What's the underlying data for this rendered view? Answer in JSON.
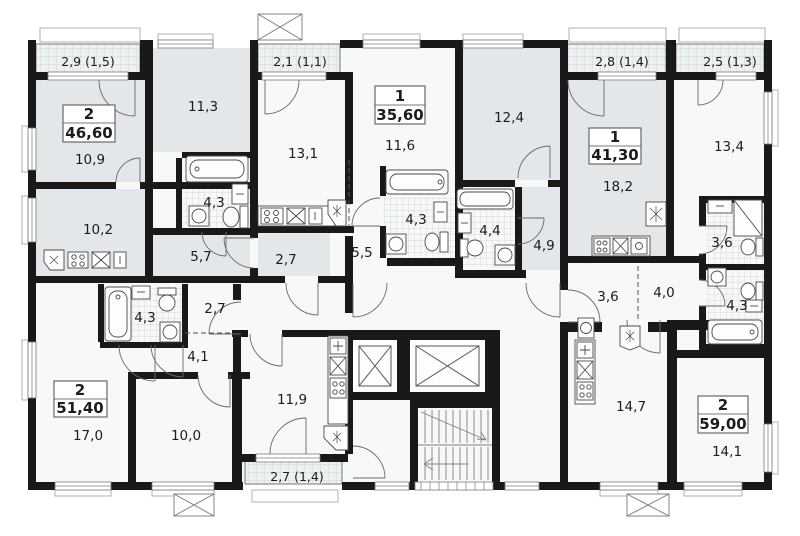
{
  "page": {
    "title": "Apartment floor plan"
  },
  "apartments": {
    "a46": {
      "rooms": "2",
      "area": "46,60"
    },
    "a35": {
      "rooms": "1",
      "area": "35,60"
    },
    "a41": {
      "rooms": "1",
      "area": "41,30"
    },
    "a51": {
      "rooms": "2",
      "area": "51,40"
    },
    "a59": {
      "rooms": "2",
      "area": "59,00"
    }
  },
  "room_areas": {
    "r10_9": "10,9",
    "r11_3": "11,3",
    "r10_2": "10,2",
    "bath_tl": "4,3",
    "kitchen_5_7": "5,7",
    "hall_2_7_top": "2,7",
    "r13_1": "13,1",
    "r11_6": "11,6",
    "bath_35": "4,3",
    "hall_5_5": "5,5",
    "r12_4": "12,4",
    "bath_4_4": "4,4",
    "hall_4_9": "4,9",
    "r18_2": "18,2",
    "r13_4": "13,4",
    "bath_3_6": "3,6",
    "bath_4_3_r": "4,3",
    "hall_3_6": "3,6",
    "hall_4_0": "4,0",
    "r14_7": "14,7",
    "r14_1": "14,1",
    "r17_0": "17,0",
    "r10_0": "10,0",
    "kitchen_11_9": "11,9",
    "bath_bl": "4,3",
    "hall_2_7_bottom": "2,7",
    "hall_4_1": "4,1"
  },
  "balconies": {
    "b1": "2,9 (1,5)",
    "b2": "2,1 (1,1)",
    "b3": "2,8 (1,4)",
    "b4": "2,5 (1,3)",
    "b5": "2,7 (1,4)"
  }
}
